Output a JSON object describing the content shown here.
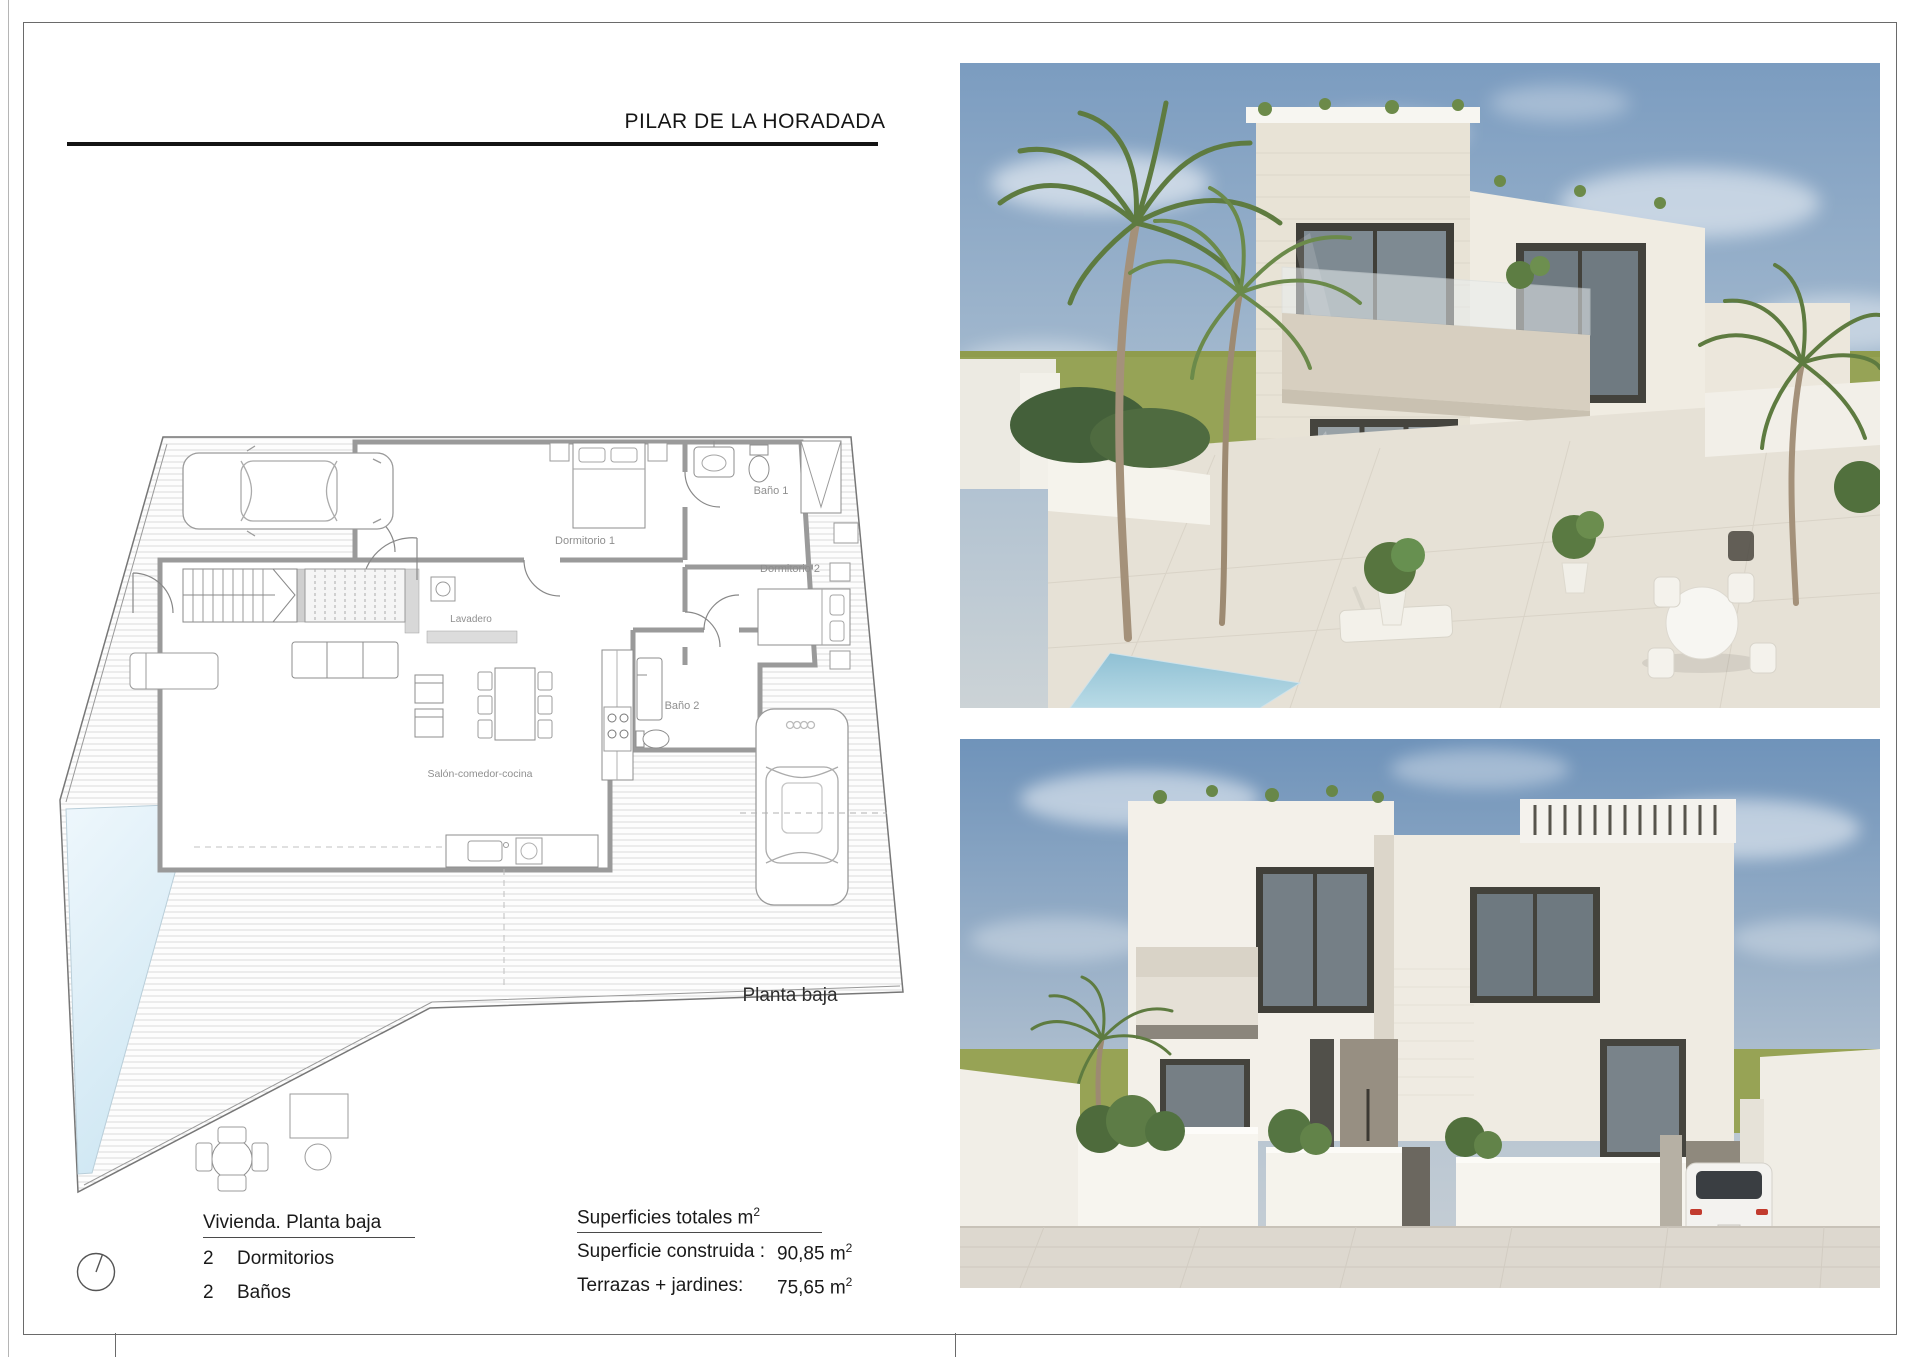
{
  "page": {
    "title": "PILAR DE LA HORADADA",
    "plan_caption": "Planta baja"
  },
  "floor_plan": {
    "labels": {
      "dormitorio1": "Dormitorio 1",
      "bano1": "Baño 1",
      "dormitorio2": "Dormitorio 2",
      "lavadero": "Lavadero",
      "bano2": "Baño 2",
      "salon": "Salón-comedor-cocina"
    }
  },
  "summary": {
    "dwelling": {
      "title": "Vivienda. Planta baja",
      "rows": [
        {
          "count": "2",
          "label": "Dormitorios"
        },
        {
          "count": "2",
          "label": "Baños"
        }
      ]
    },
    "surfaces": {
      "title": "Superficies totales m",
      "title_sup": "2",
      "rows": [
        {
          "label": "Superficie construida :",
          "value": "90,85 m",
          "sup": "2"
        },
        {
          "label": "Terrazas + jardines:",
          "value": "75,65 m",
          "sup": "2"
        }
      ]
    }
  },
  "colors": {
    "pool_blue": "#d9ecf6",
    "grass_green": "#96a356",
    "sky_blue": "#7b9cc0",
    "wall_gray": "#9a9a9a",
    "paving": "#e6e1d6"
  }
}
